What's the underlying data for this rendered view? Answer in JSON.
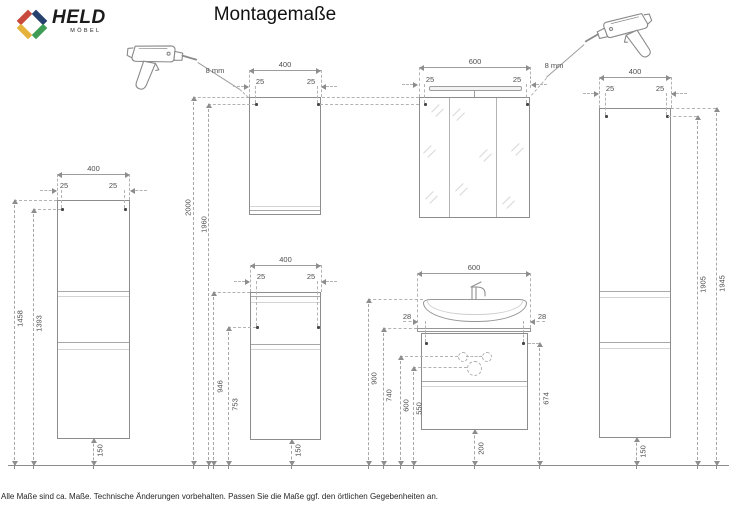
{
  "header": {
    "brand": "HELD",
    "brand_sub": "MÖBEL",
    "title": "Montagemaße"
  },
  "notes": {
    "drill_left": "8 mm",
    "drill_right": "8 mm"
  },
  "units": {
    "left_tall_cabinet": {
      "width": "400",
      "offset_left": "25",
      "offset_right": "25",
      "height_top": "1458",
      "height_drill": "1393",
      "floor_gap": "150"
    },
    "wall_cabinet": {
      "width": "400",
      "offset_left": "25",
      "offset_right": "25",
      "height_top": "2000",
      "height_drill": "1960"
    },
    "mid_cabinet": {
      "width": "400",
      "offset_left": "25",
      "offset_right": "25",
      "height_top": "946",
      "height_drill": "753",
      "floor_gap": "150"
    },
    "mirror_cabinet": {
      "width": "600",
      "offset_left": "25",
      "offset_right": "25"
    },
    "vanity": {
      "width": "600",
      "offset_left": "28",
      "offset_right": "28",
      "height_sink": "900",
      "height_top": "740",
      "height_holes": "600",
      "height_trap": "550",
      "height_drill": "674",
      "floor_gap": "200"
    },
    "right_tall_cabinet": {
      "width": "400",
      "offset_left": "25",
      "offset_right": "25",
      "height_top": "1945",
      "height_drill": "1905",
      "floor_gap": "150"
    }
  },
  "footer": {
    "disclaimer": "Alle Maße sind ca. Maße. Technische Änderungen vorbehalten. Passen Sie die Maße ggf. den örtlichen Gegebenheiten an."
  },
  "colors": {
    "logo_red": "#c94a3c",
    "logo_blue": "#27416e",
    "logo_green": "#3f9c55",
    "logo_yellow": "#e5b33b",
    "line_gray": "#8d8d8d",
    "dash_gray": "#b3b3b3",
    "text_gray": "#4f4f4f"
  }
}
